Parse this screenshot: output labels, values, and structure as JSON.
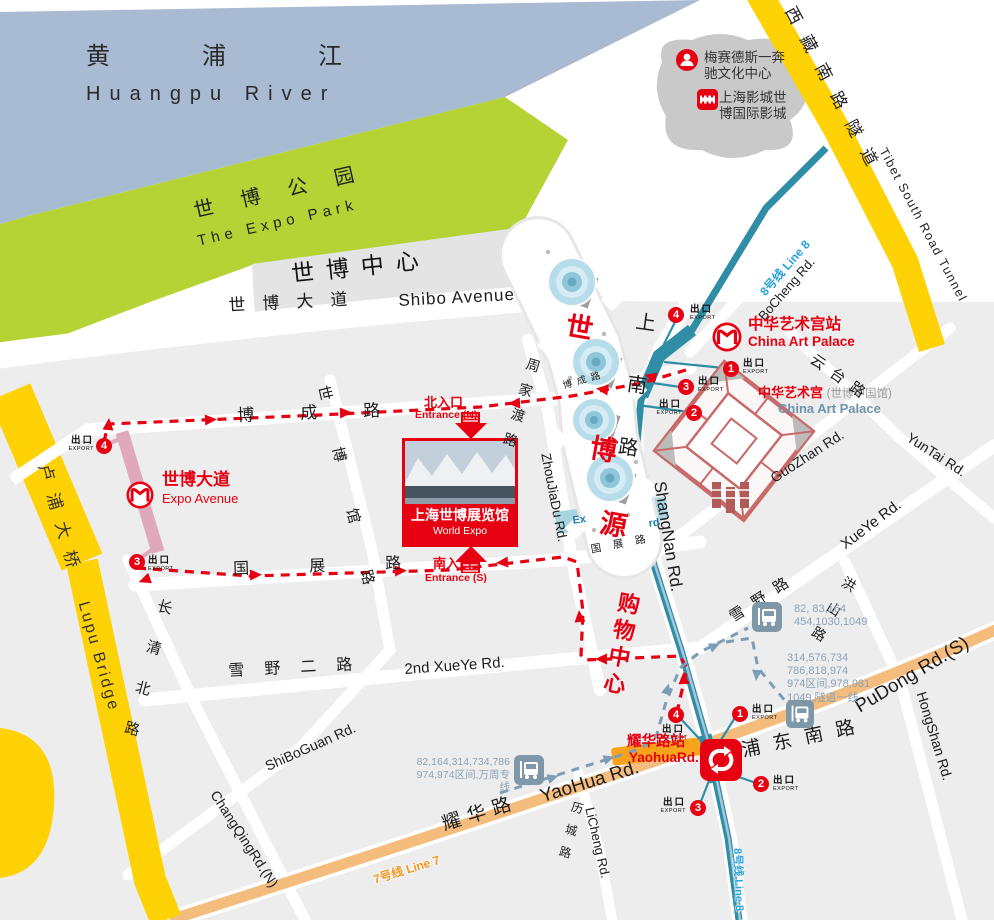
{
  "colors": {
    "water": "#a9bad3",
    "park": "#b5d334",
    "yellow_road": "#ffd205",
    "city_block": "#ededed",
    "metro_line8": "#2f8ea6",
    "line7_road": "#f5bd7d",
    "station_pill": "#f9a31d",
    "accent_red": "#e60012",
    "bus_icon": "#7e97a9",
    "bus_text": "#8ba3b8",
    "dash_blue": "#7d9cb5",
    "palace_outline": "#c96a6a",
    "line8_text": "#2aa3dc",
    "line7_text": "#f7941d",
    "pink_station": "#dfa9bb",
    "palace_en_blue": "#6d94ac"
  },
  "water": {
    "cn": "黄浦江",
    "en": "Huangpu River"
  },
  "park": {
    "cn": "世博公园",
    "en": "The Expo Park"
  },
  "expo_center": {
    "cn": "世博中心"
  },
  "legend": {
    "mercedes": {
      "line1": "梅赛德斯一奔",
      "line2": "驰文化中心"
    },
    "cinema": {
      "line1": "上海影城世",
      "line2": "博国际影城"
    }
  },
  "roads": {
    "shibo_avenue": {
      "cn": "世博大道",
      "en": "Shibo Avenue"
    },
    "bocheng_w": {
      "cn": "博成路"
    },
    "bocheng_small": {
      "cn": "博成路"
    },
    "bocheng_ne": {
      "en": "BoCheng Rd."
    },
    "guozhan_w": {
      "cn": "国展路"
    },
    "guozhan_e": {
      "cn": "国展路"
    },
    "guozhan_ne": {
      "en": "GuoZhan Rd."
    },
    "xueye2": {
      "cn": "雪野二路",
      "en": "2nd XueYe Rd."
    },
    "shiboguan": {
      "cn": "世博馆路",
      "en": "ShiBoGuan Rd."
    },
    "changqing": {
      "cn": "长清北路",
      "en": "ChangQingRd.(N)"
    },
    "licheng": {
      "cn": "历城路",
      "en": "LiCheng Rd."
    },
    "zhoujiadu": {
      "cn": "周家渡路",
      "en": "ZhouJiaDu Rd."
    },
    "shangnan": {
      "cn": "上南路",
      "en": "ShangNan Rd."
    },
    "xueye_e": {
      "cn": "雪野路",
      "en": "XueYe Rd."
    },
    "yuntai": {
      "cn": "云台路",
      "en": "YunTai Rd."
    },
    "hongshan": {
      "cn": "洪山路",
      "en": "HongShan Rd."
    },
    "yaohua": {
      "cn": "耀华路",
      "en": "YaoHua Rd."
    },
    "pudong": {
      "cn": "浦东南路",
      "en": "PuDong Rd.(S)"
    },
    "lupu": {
      "cn": "卢浦大桥",
      "en": "Lupu Bridge"
    },
    "tunnel": {
      "cn": "西藏南路隧道",
      "en": "Tibet South Road Tunnel"
    }
  },
  "metro": {
    "line8_label": "8号线 Line 8",
    "line7_label": "7号线 Line 7",
    "exit": {
      "cn": "出口",
      "en": "EXPORT"
    },
    "stations": {
      "china_art_palace": {
        "cn": "中华艺术宫站",
        "en": "China Art Palace",
        "exits": [
          "4",
          "1",
          "3",
          "2"
        ]
      },
      "expo_avenue": {
        "cn": "世博大道",
        "en": "Expo Avenue",
        "exits": [
          "4",
          "3"
        ]
      },
      "yaohua": {
        "cn": "耀华路站",
        "en": "YaohuaRd.",
        "exits": [
          "4",
          "1",
          "2",
          "3"
        ]
      }
    }
  },
  "pois": {
    "china_art_palace": {
      "cn": "中华艺术宫",
      "sub": "(世博中国馆)",
      "en": "China Art Palace"
    },
    "world_expo": {
      "cn": "上海世博展览馆",
      "en": "World Expo"
    },
    "expo_axis": {
      "chars": [
        "世",
        "博",
        "源"
      ],
      "fragment_left": "Ex",
      "fragment_right": "rd"
    },
    "shopping": {
      "cn": "购物中心"
    }
  },
  "entrances": {
    "north": {
      "cn": "北入口",
      "en": "Entrance (N)"
    },
    "south": {
      "cn": "南入口",
      "en": "Entrance (S)"
    }
  },
  "bus_stops": [
    {
      "line1": "82, 83,164",
      "line2": "454,1030,1049"
    },
    {
      "line1": "314,576,734",
      "line2": "786,818,974",
      "line3": "974区间,978,981",
      "line4": "1049,隧道一线"
    },
    {
      "line1": "82,164,314,734,786",
      "line2": "974,974区间,万周专线"
    }
  ]
}
